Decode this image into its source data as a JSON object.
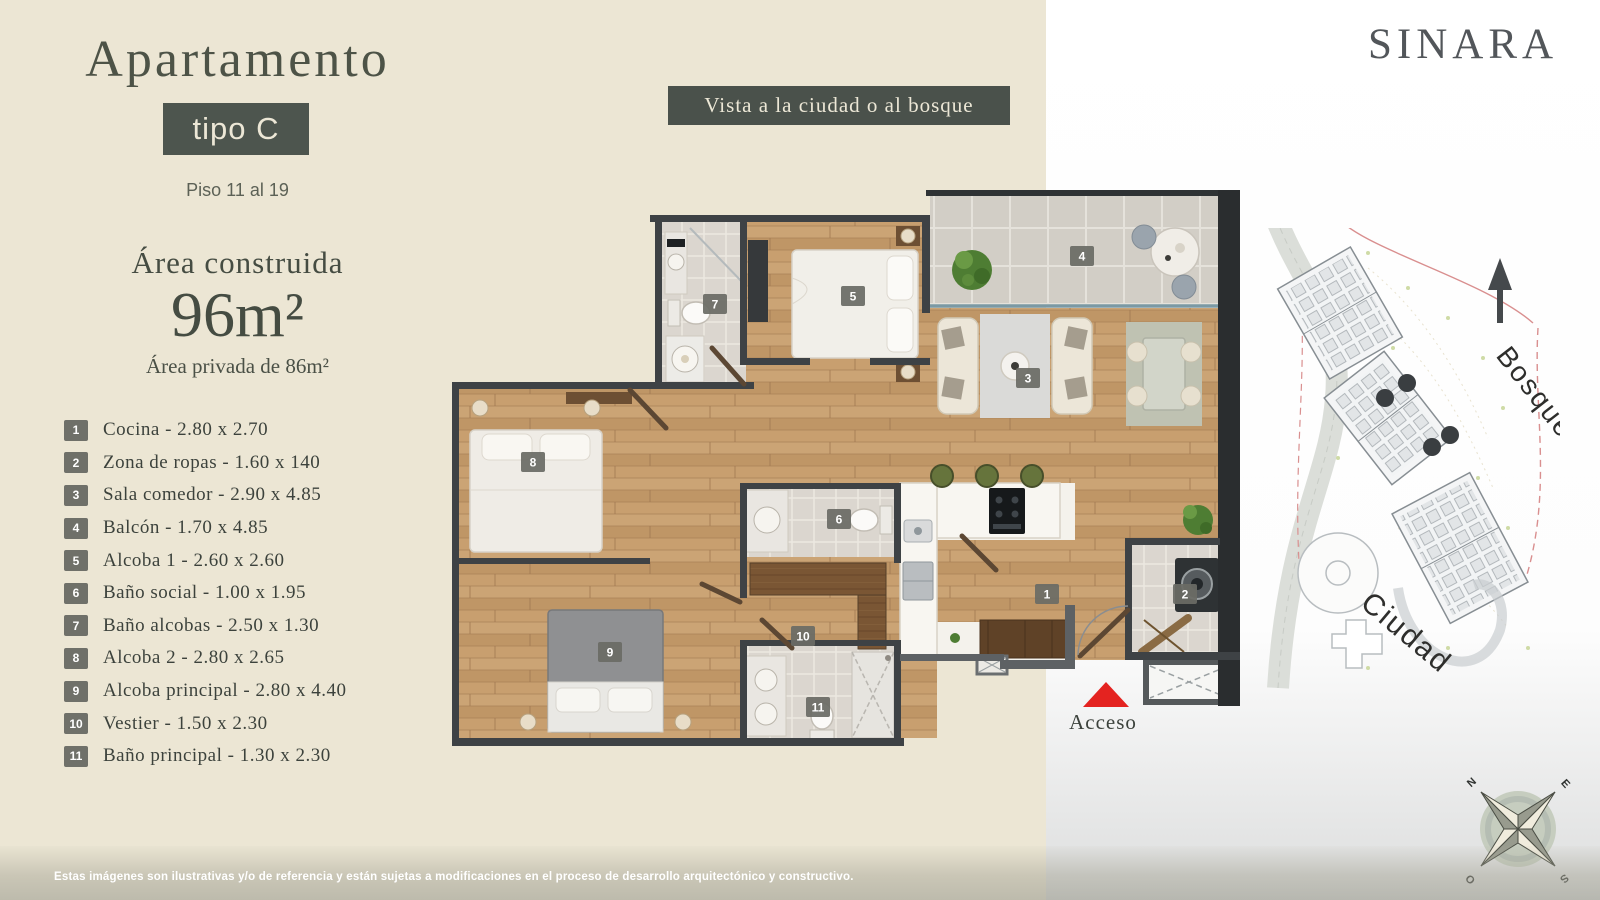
{
  "brand": {
    "logo_text": "SINARA"
  },
  "header": {
    "title": "Apartamento",
    "type_label": "tipo C",
    "floors_label": "Piso 11 al 19"
  },
  "area": {
    "built_label": "Área construida",
    "built_value": "96m²",
    "private_label": "Área privada de 86m²"
  },
  "view_banner": {
    "text": "Vista a la ciudad o al bosque"
  },
  "legend": {
    "items": [
      {
        "num": "1",
        "name": "Cocina",
        "size": "2.80 x 2.70"
      },
      {
        "num": "2",
        "name": "Zona de ropas",
        "size": "1.60 x 140"
      },
      {
        "num": "3",
        "name": "Sala comedor",
        "size": "2.90 x 4.85"
      },
      {
        "num": "4",
        "name": "Balcón",
        "size": "1.70 x 4.85"
      },
      {
        "num": "5",
        "name": "Alcoba 1",
        "size": "2.60 x 2.60"
      },
      {
        "num": "6",
        "name": "Baño social",
        "size": "1.00 x 1.95"
      },
      {
        "num": "7",
        "name": "Baño alcobas",
        "size": "2.50 x 1.30"
      },
      {
        "num": "8",
        "name": "Alcoba 2",
        "size": "2.80 x 2.65"
      },
      {
        "num": "9",
        "name": "Alcoba principal",
        "size": "2.80 x 4.40"
      },
      {
        "num": "10",
        "name": "Vestier",
        "size": "1.50 x 2.30"
      },
      {
        "num": "11",
        "name": "Baño principal",
        "size": "1.30 x 2.30"
      }
    ]
  },
  "plan": {
    "acceso_label": "Acceso"
  },
  "sitemap": {
    "bosque_label": "Bosque",
    "ciudad_label": "Ciudad"
  },
  "compass": {
    "n": "N",
    "e": "E",
    "s": "S",
    "o": "O"
  },
  "footer": {
    "disclaimer": "Estas imágenes son ilustrativas y/o de referencia y están sujetas a modificaciones en el proceso de desarrollo arquitectónico y constructivo."
  },
  "colors": {
    "cream": "#ece6d4",
    "dark_green": "#4a514b",
    "accent_red": "#e42320",
    "wood": "#c39b6c",
    "wall": "#3e4245"
  }
}
